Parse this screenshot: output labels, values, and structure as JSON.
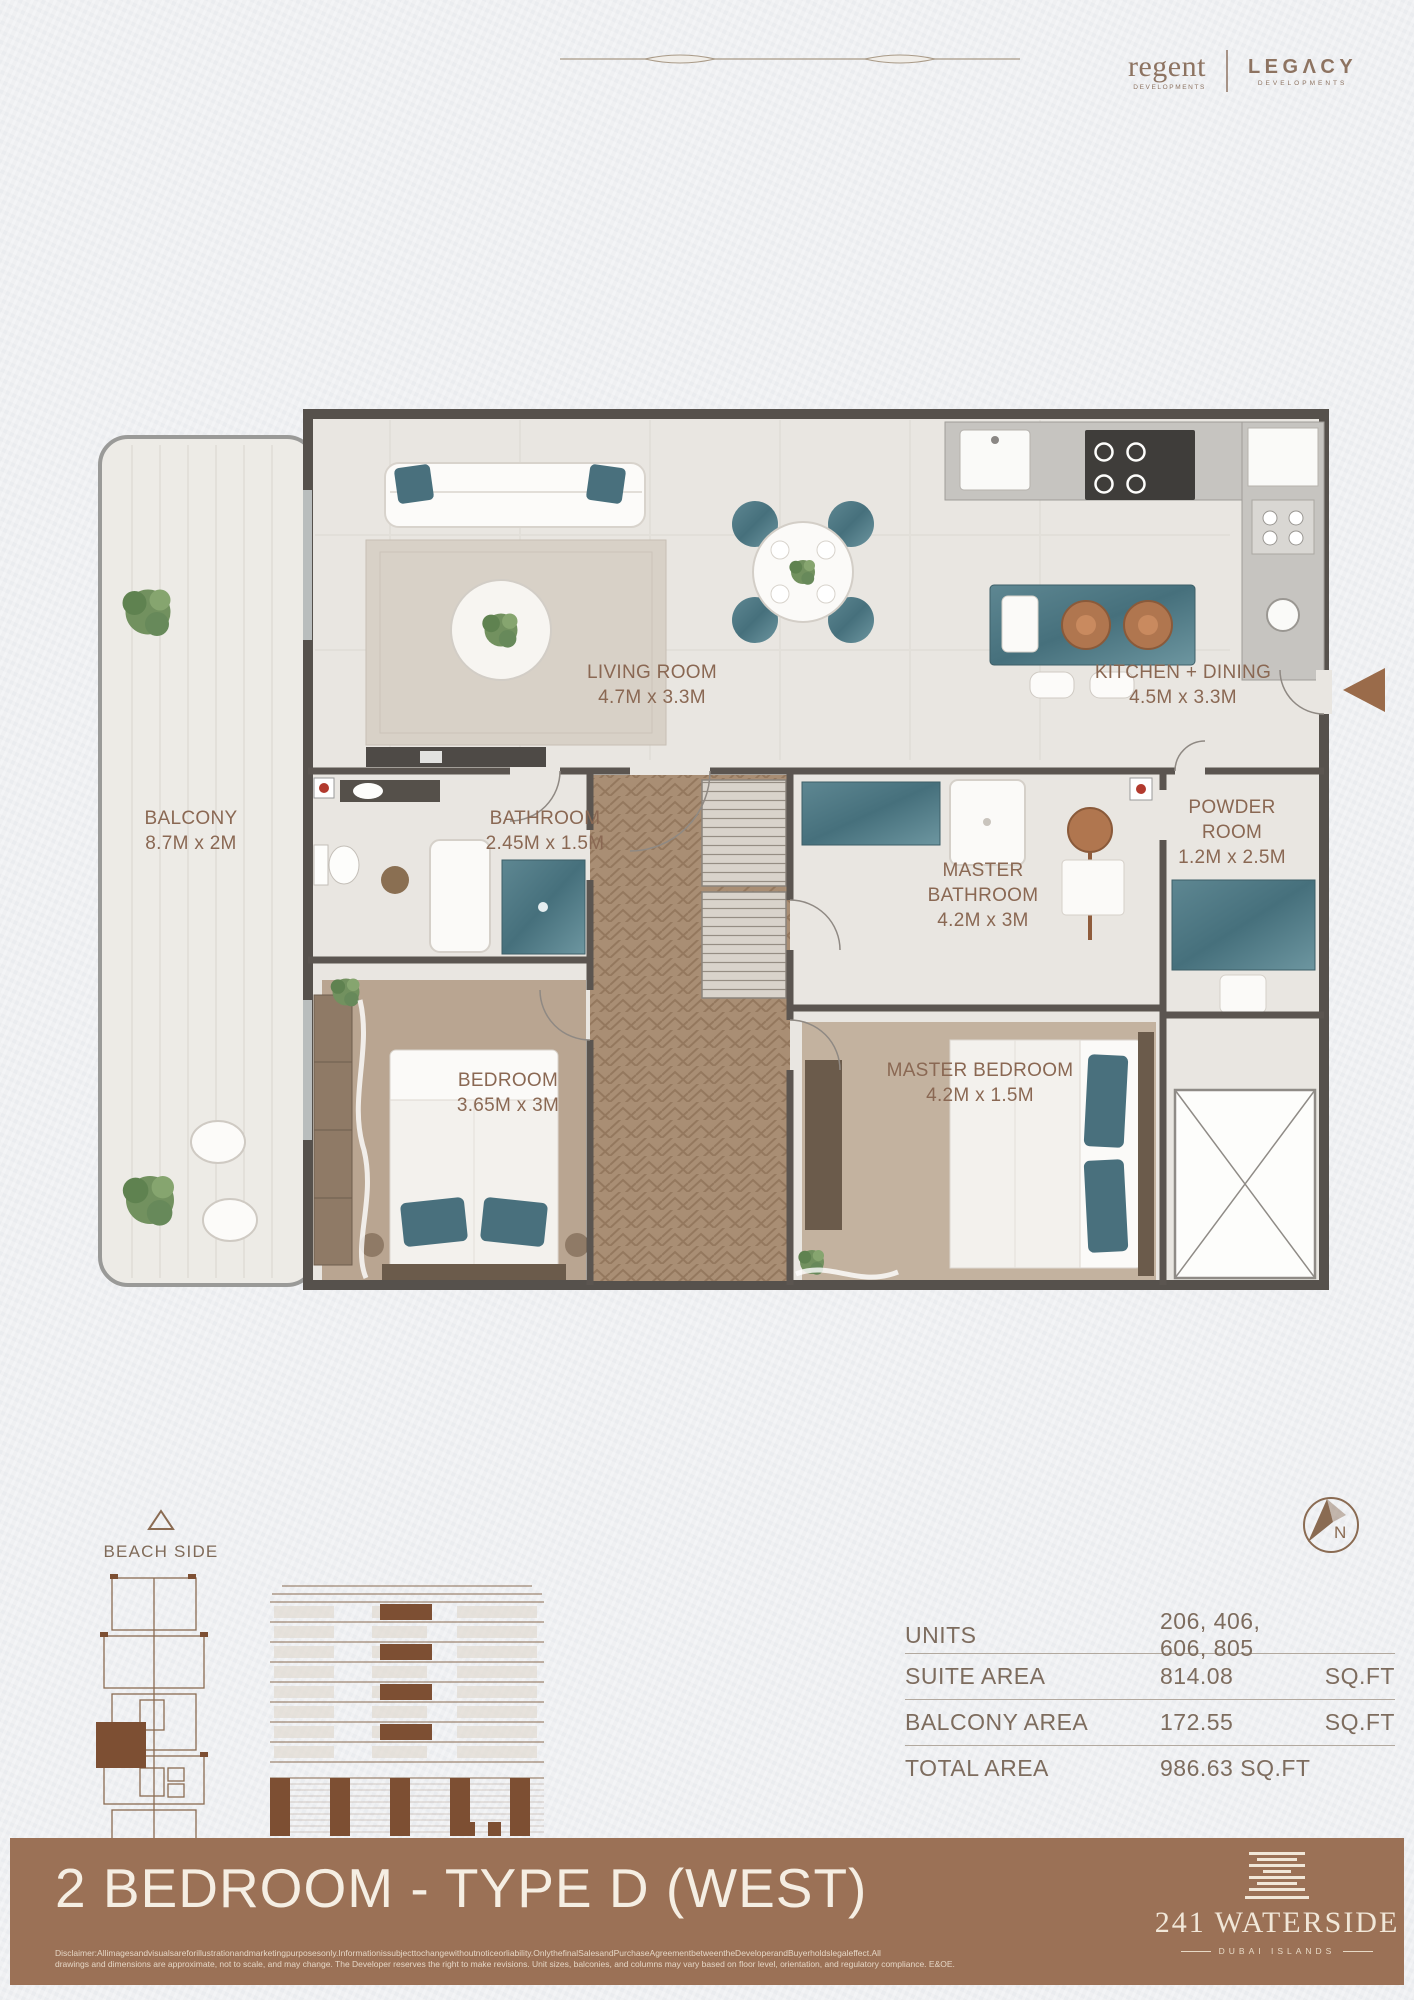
{
  "header": {
    "brand_left": {
      "name": "regent",
      "tagline": "DEVELOPMENTS"
    },
    "brand_right": {
      "name": "LEGΛCY",
      "tagline": "DEVELOPMENTS"
    }
  },
  "floorplan": {
    "rooms": [
      {
        "name": "LIVING ROOM",
        "dims": "4.7M x 3.3M"
      },
      {
        "name": "KITCHEN + DINING",
        "dims": "4.5M x 3.3M"
      },
      {
        "name": "BALCONY",
        "dims": "8.7M x 2M"
      },
      {
        "name": "BATHROOM",
        "dims": "2.45M x 1.5M"
      },
      {
        "name": "MASTER BATHROOM",
        "dims": "4.2M x 3M"
      },
      {
        "name": "POWDER ROOM",
        "dims": "1.2M x 2.5M"
      },
      {
        "name": "BEDROOM",
        "dims": "3.65M x 3M"
      },
      {
        "name": "MASTER BEDROOM",
        "dims": "4.2M x 1.5M"
      }
    ]
  },
  "orientation": {
    "beach_side_label": "BEACH SIDE",
    "compass_label": "N"
  },
  "area_table": {
    "rows": [
      {
        "label": "UNITS",
        "value": "206, 406, 606, 805",
        "unit": ""
      },
      {
        "label": "SUITE AREA",
        "value": "814.08",
        "unit": "SQ.FT"
      },
      {
        "label": "BALCONY AREA",
        "value": "172.55",
        "unit": "SQ.FT"
      },
      {
        "label": "TOTAL AREA",
        "value": "986.63 SQ.FT",
        "unit": ""
      }
    ]
  },
  "footer": {
    "plan_title": "2 BEDROOM - TYPE D (WEST)",
    "disclaimer_line1": "Disclaimer:Allimagesandvisualsareforillustrationandmarketingpurposesonly.Informationissubjecttochangewithoutnoticeorliability.OnlythefinalSalesandPurchaseAgreementbetweentheDeveloperandBuyerholdslegaleffect.All",
    "disclaimer_line2": "drawings and dimensions are approximate, not to scale, and may change. The Developer reserves the right to make revisions. Unit sizes, balconies, and columns may vary based on floor level, orientation, and regulatory compliance. E&OE.",
    "project": {
      "name": "241 WATERSIDE",
      "location": "DUBAI ISLANDS"
    }
  },
  "colors": {
    "accent_brown": "#8a6853",
    "footer_brown": "#9b7156",
    "cream": "#f4ecdf",
    "teal_marble": "#53798a",
    "wall_gray": "#56514c",
    "highlight_brown": "#7d4f33"
  }
}
